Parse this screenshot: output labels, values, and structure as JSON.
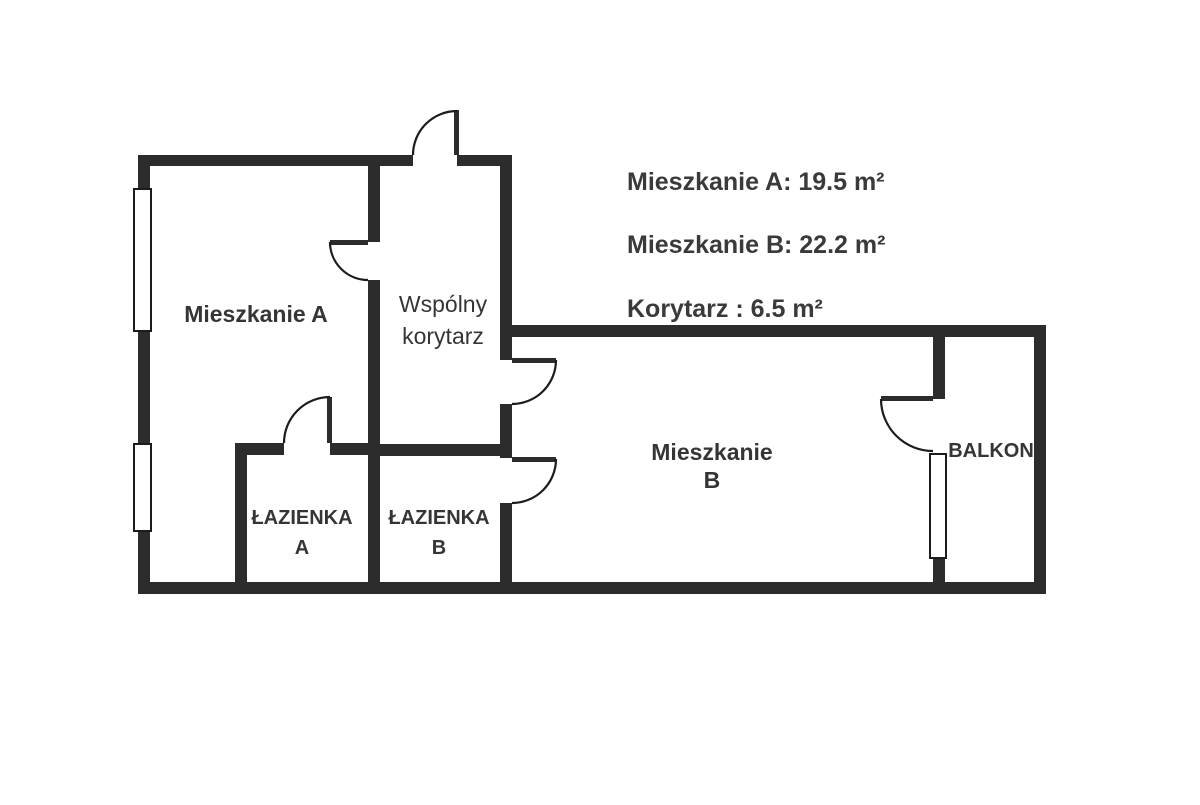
{
  "colors": {
    "wall": "#2c2c2c",
    "line": "#1c1c1c",
    "window_fill": "#ffffff",
    "text": "#353535"
  },
  "rooms": {
    "mieszkanie_a": {
      "label": "Mieszkanie A"
    },
    "korytarz": {
      "line1": "Wspólny",
      "line2": "korytarz"
    },
    "mieszkanie_b": {
      "line1": "Mieszkanie",
      "line2": "B"
    },
    "lazienka_a": {
      "line1": "ŁAZIENKA",
      "line2": "A"
    },
    "lazienka_b": {
      "line1": "ŁAZIENKA",
      "line2": "B"
    },
    "balkon": {
      "label": "BALKON"
    }
  },
  "legend": {
    "items": [
      {
        "text": "Mieszkanie A: 19.5 m²"
      },
      {
        "text": "Mieszkanie B: 22.2 m²"
      },
      {
        "text": "Korytarz : 6.5 m²"
      }
    ]
  },
  "areas_m2": {
    "mieszkanie_a": 19.5,
    "mieszkanie_b": 22.2,
    "korytarz": 6.5
  }
}
